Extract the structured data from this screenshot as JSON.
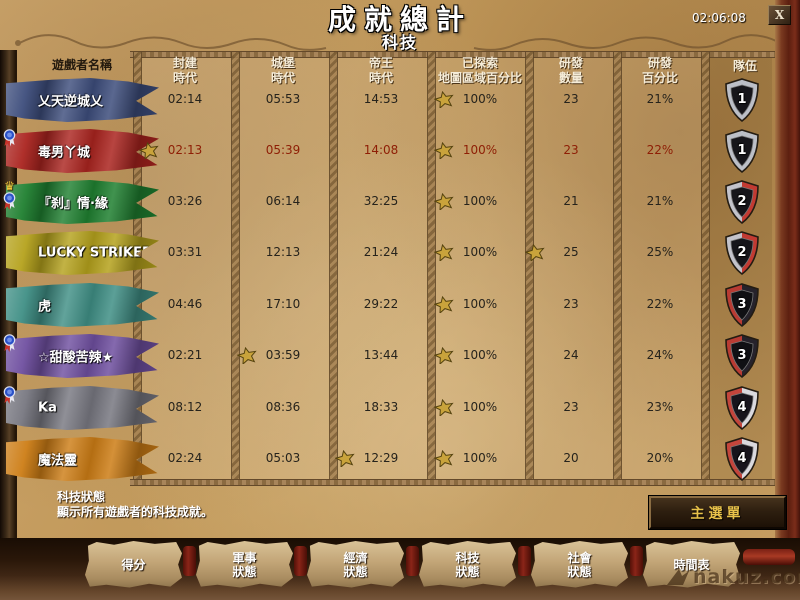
{
  "window": {
    "title": "成就總計",
    "subtitle": "科技",
    "time": "02:06:08",
    "close_label": "X"
  },
  "table": {
    "players_header": "遊戲者名稱",
    "team_header": "隊伍",
    "columns": [
      {
        "line1": "封建",
        "line2": "時代"
      },
      {
        "line1": "城堡",
        "line2": "時代"
      },
      {
        "line1": "帝王",
        "line2": "時代"
      },
      {
        "line1": "已探索",
        "line2": "地圖區域百分比"
      },
      {
        "line1": "研發",
        "line2": "數量"
      },
      {
        "line1": "研發",
        "line2": "百分比"
      }
    ],
    "star_color": "#c9a33b",
    "players": [
      {
        "name": "乂天逆城乂",
        "banner_color": "#3d4d7c",
        "text_color": "#26231c",
        "values": [
          "02:14",
          "05:53",
          "14:53",
          "100%",
          "23",
          "21%"
        ],
        "stars": [
          3
        ],
        "team": "1",
        "shield": {
          "left": "#bcbfc7",
          "right": "#bcbfc7",
          "center": "#16151a"
        },
        "medals": []
      },
      {
        "name": "毒男丫城",
        "banner_color": "#ab241f",
        "text_color": "#8e1e05",
        "values": [
          "02:13",
          "05:39",
          "14:08",
          "100%",
          "23",
          "22%"
        ],
        "stars": [
          0,
          3
        ],
        "team": "1",
        "shield": {
          "left": "#bcbfc7",
          "right": "#bcbfc7",
          "center": "#16151a"
        },
        "medals": [
          "ribbon"
        ]
      },
      {
        "name": "『刹』情·緣",
        "banner_color": "#1f8030",
        "text_color": "#26231c",
        "values": [
          "03:26",
          "06:14",
          "32:25",
          "100%",
          "21",
          "21%"
        ],
        "stars": [
          3
        ],
        "team": "2",
        "shield": {
          "left": "#c3c3cb",
          "right": "#c23a32",
          "center": "#16151a"
        },
        "medals": [
          "crown",
          "ribbon"
        ]
      },
      {
        "name": "LUCKY STRIKER",
        "banner_color": "#b5a21c",
        "text_color": "#26231c",
        "values": [
          "03:31",
          "12:13",
          "21:24",
          "100%",
          "25",
          "25%"
        ],
        "stars": [
          3,
          4
        ],
        "team": "2",
        "shield": {
          "left": "#c3c3cb",
          "right": "#c23a32",
          "center": "#16151a"
        },
        "medals": []
      },
      {
        "name": "虎",
        "banner_color": "#3f8f85",
        "text_color": "#26231c",
        "values": [
          "04:46",
          "17:10",
          "29:22",
          "100%",
          "23",
          "22%"
        ],
        "stars": [
          3
        ],
        "team": "3",
        "shield": {
          "left": "#b93b33",
          "right": "#26222b",
          "center": "#101014"
        },
        "medals": []
      },
      {
        "name": "☆甜酸苦辣★",
        "banner_color": "#6f4fa0",
        "text_color": "#26231c",
        "values": [
          "02:21",
          "03:59",
          "13:44",
          "100%",
          "24",
          "24%"
        ],
        "stars": [
          1,
          3
        ],
        "team": "3",
        "shield": {
          "left": "#b93b33",
          "right": "#26222b",
          "center": "#101014"
        },
        "medals": [
          "ribbon"
        ]
      },
      {
        "name": "Ka",
        "banner_color": "#777780",
        "text_color": "#26231c",
        "values": [
          "08:12",
          "08:36",
          "18:33",
          "100%",
          "23",
          "23%"
        ],
        "stars": [
          3
        ],
        "team": "4",
        "shield": {
          "left": "#c4453c",
          "right": "#dad9de",
          "center": "#17141c"
        },
        "medals": [
          "ribbon"
        ]
      },
      {
        "name": "魔法靈",
        "banner_color": "#cd7d15",
        "text_color": "#26231c",
        "values": [
          "02:24",
          "05:03",
          "12:29",
          "100%",
          "20",
          "20%"
        ],
        "stars": [
          2,
          3
        ],
        "team": "4",
        "shield": {
          "left": "#c4453c",
          "right": "#dad9de",
          "center": "#17141c"
        },
        "medals": []
      }
    ]
  },
  "footer": {
    "status_title": "科技狀態",
    "status_description": "顯示所有遊戲者的科技成就。",
    "main_menu_label": "主選單"
  },
  "tabs": [
    {
      "line1": "得分",
      "line2": ""
    },
    {
      "line1": "軍事",
      "line2": "狀態"
    },
    {
      "line1": "經濟",
      "line2": "狀態"
    },
    {
      "line1": "科技",
      "line2": "狀態"
    },
    {
      "line1": "社會",
      "line2": "狀態"
    },
    {
      "line1": "時間表",
      "line2": ""
    }
  ],
  "watermark": "nakuz.com"
}
